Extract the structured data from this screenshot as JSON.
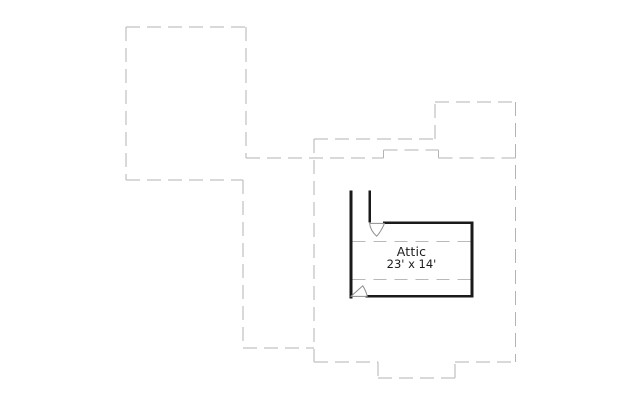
{
  "room": {
    "name": "Attic",
    "dimensions": "23' x 14'"
  },
  "colors": {
    "background": "#ffffff",
    "roof_outline": "#b3b3b3",
    "wall": "#1a1a1a",
    "ceiling_break": "#b9b9b9",
    "door_stroke": "#8e8e8e",
    "door_fill": "#ffffff",
    "label_text": "#1c1c1c"
  }
}
